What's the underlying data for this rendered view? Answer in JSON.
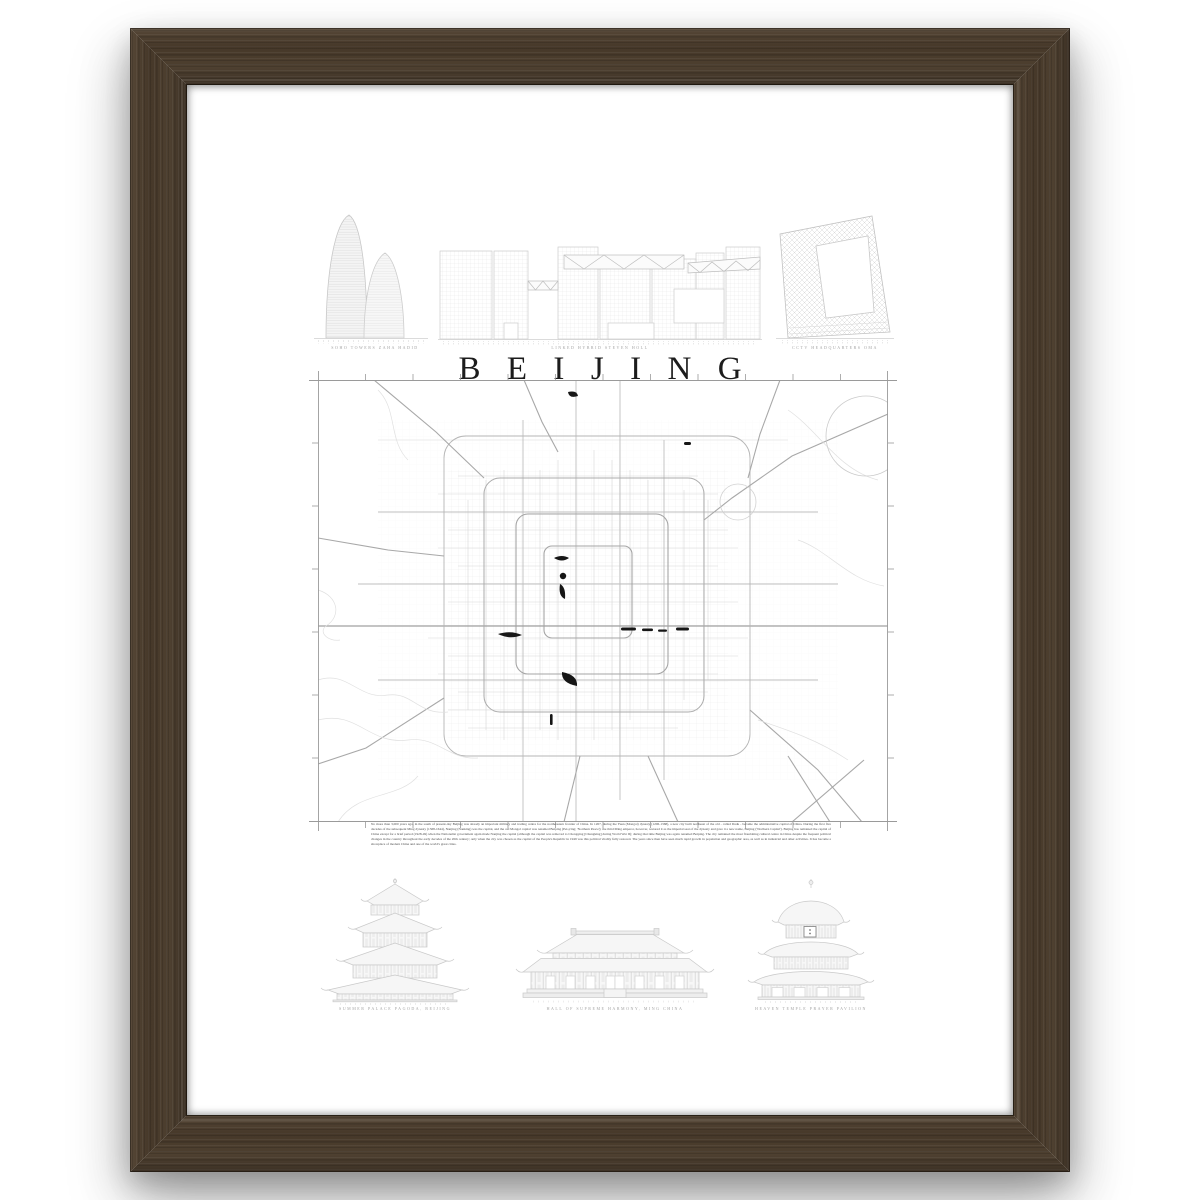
{
  "poster": {
    "title": "BEIJING",
    "skyline": {
      "items": [
        {
          "name": "wangjing-soho-towers",
          "label": "SOHO TOWERS ZAHA HADID"
        },
        {
          "name": "linked-hybrid",
          "label": "LINKED HYBRID STEVEN HOLL"
        },
        {
          "name": "cctv-headquarters",
          "label": "CCTV HEADQUARTERS OMA"
        }
      ]
    },
    "description": "No more than 3,000 years ago, in the south of present-day Beijing was already an important military and trading centre for the northeastern frontier of China. In 1267, during the Yuan (Mongol) dynasty (1206-1368), a new city built northeast of the old - called Dadu - became the administrative capital of China. During the first five decades of the subsequent Ming dynasty (1368-1644), Nanjing (Nanking) was the capital, and the old Mongol capital was renamed Beiping (Pei-p'ing; 'Northern Peace'); the third Ming emperor, however, restored it as the imperial seat of the dynasty and gave it a new name, Beijing ('Northern Capital'). Beijing has remained the capital of China except for a brief period (1928-49) when the Nationalist government again made Nanjing the capital (although the capital was removed to Chongqing [Chungking] during World War II); during that time Beijing was again renamed Beiping. The city remained the most flourishing cultural centre in China despite the frequent political changes in the country throughout the early decades of the 20th century; only when the city was chosen as the capital of the People's Republic in 1949 was this political vitality fully restored. The years since then have seen much rapid growth in population and geographic area, as well as in industrial and other activities. It has become a showplace of modern China and one of the world's great cities.",
    "landmarks": {
      "items": [
        {
          "name": "summer-palace-pagoda",
          "label": "SUMMER PALACE PAGODA, BEIJING"
        },
        {
          "name": "hall-of-supreme-harmony",
          "label": "HALL OF SUPREME HARMONY, MING CHINA"
        },
        {
          "name": "temple-of-heaven-prayer-hall",
          "label": "HEAVEN TEMPLE PRAYER PAVILION"
        }
      ]
    }
  },
  "frame": {
    "wood_color": "#47392b",
    "mat_color": "#ffffff",
    "page_background": "#ffffff",
    "map_line_color": "#9a9a9a",
    "lake_color": "#161616"
  }
}
